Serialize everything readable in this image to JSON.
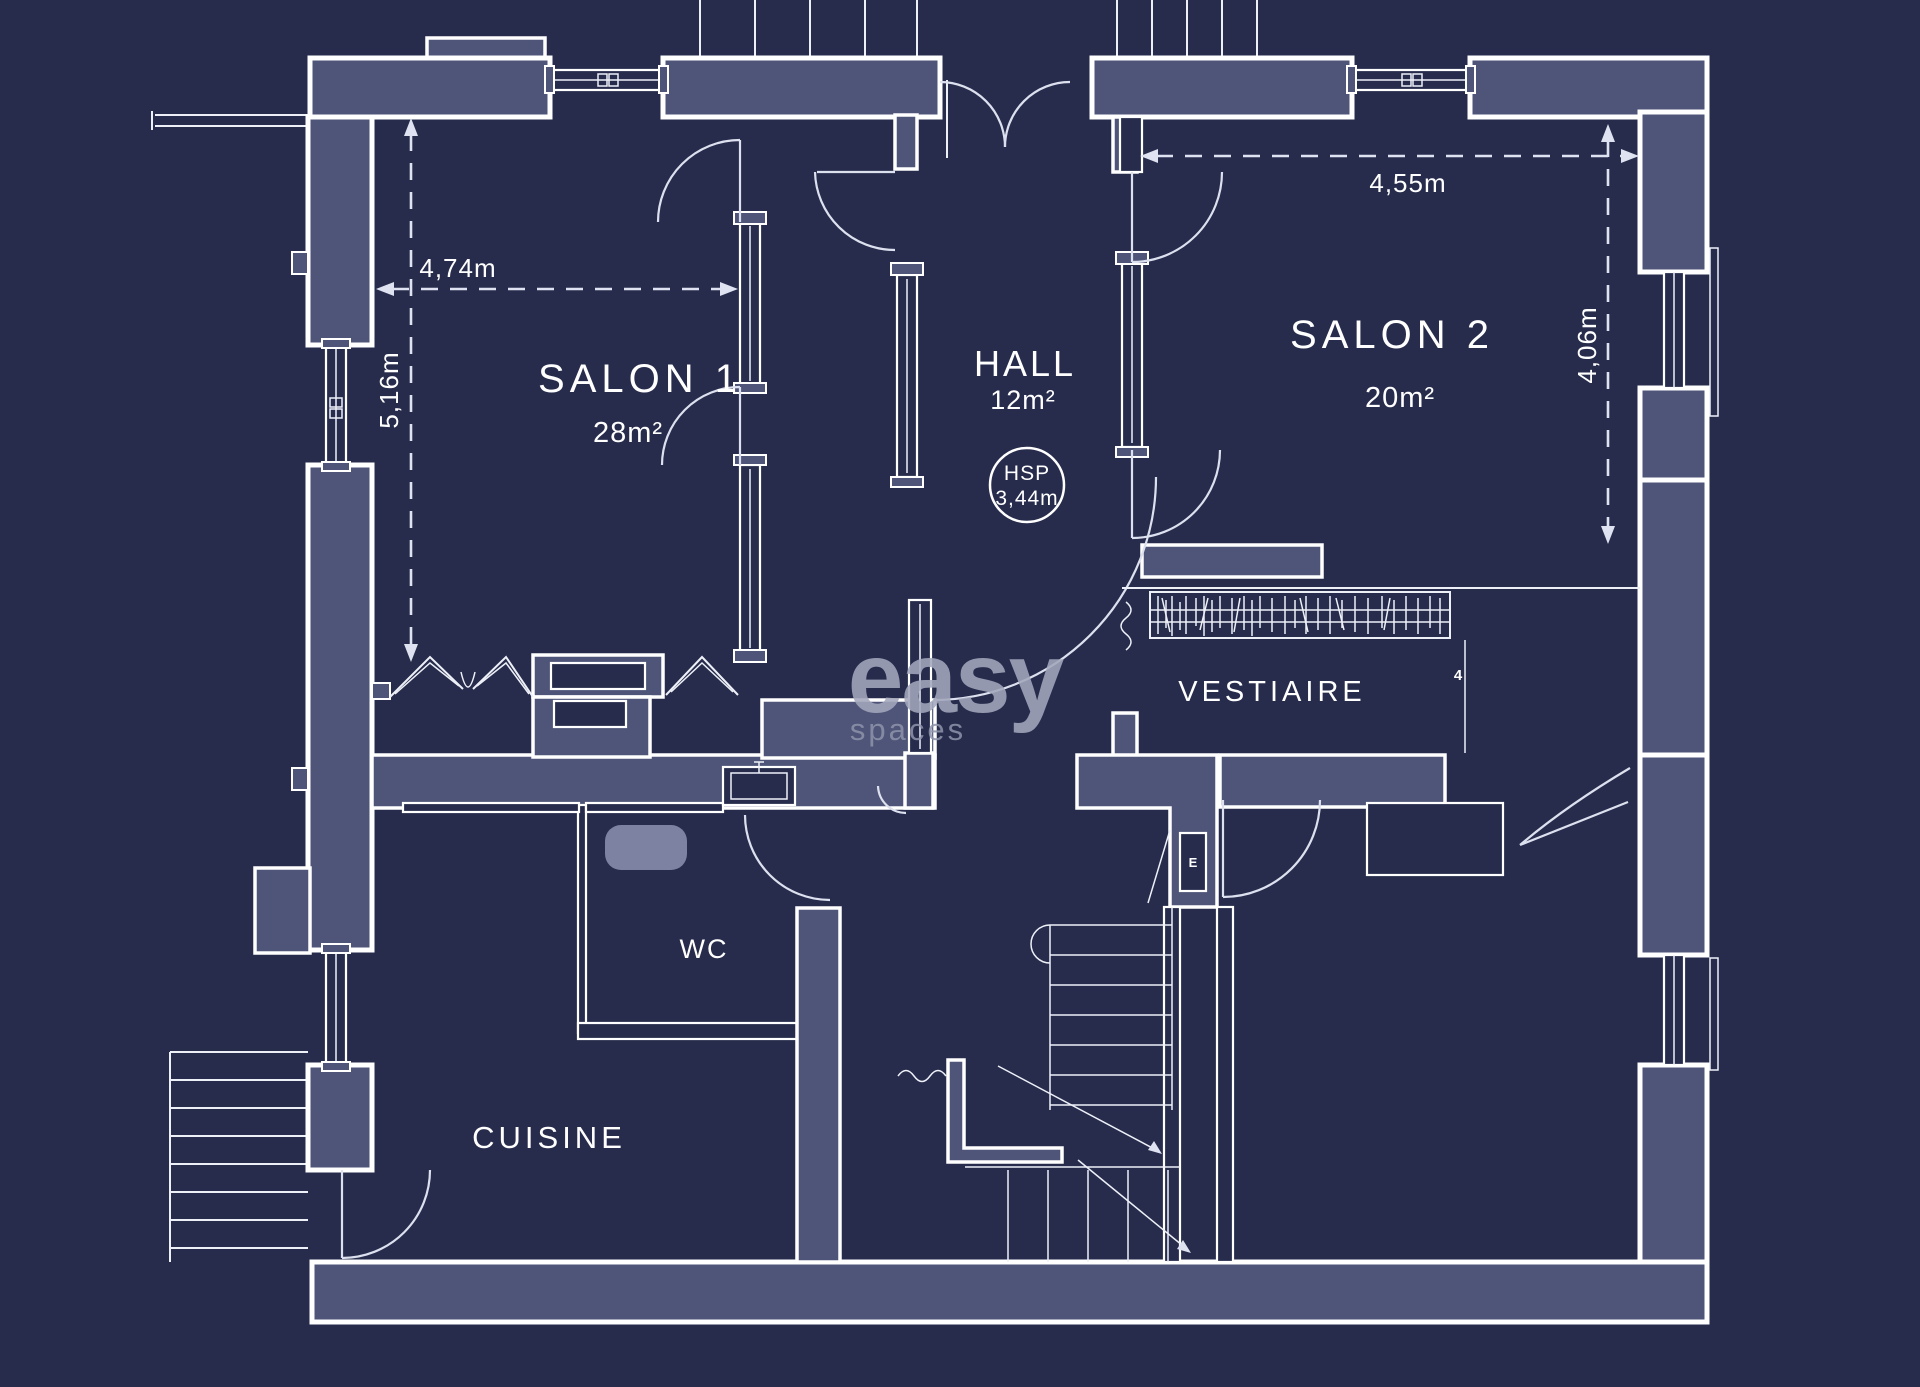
{
  "plan": {
    "type": "floor-plan-blueprint",
    "rooms": [
      {
        "id": "salon-1",
        "name": "SALON 1",
        "area": "28m²"
      },
      {
        "id": "hall",
        "name": "HALL",
        "area": "12m²"
      },
      {
        "id": "salon-2",
        "name": "SALON 2",
        "area": "20m²"
      },
      {
        "id": "vestiaire",
        "name": "VESTIAIRE",
        "area": ""
      },
      {
        "id": "wc",
        "name": "WC",
        "area": ""
      },
      {
        "id": "cuisine",
        "name": "CUISINE",
        "area": ""
      }
    ],
    "dimensions": [
      {
        "id": "salon1-width",
        "value": "4,74m",
        "orientation": "horizontal"
      },
      {
        "id": "salon1-depth",
        "value": "5,16m",
        "orientation": "vertical"
      },
      {
        "id": "salon2-width",
        "value": "4,55m",
        "orientation": "horizontal"
      },
      {
        "id": "salon2-depth",
        "value": "4,06m",
        "orientation": "vertical"
      }
    ],
    "ceiling_height": {
      "label": "HSP",
      "value": "3,44m"
    },
    "marks": {
      "electrical_panel": "E",
      "closet_dimension": "4"
    },
    "watermark": {
      "brand": "easy",
      "sub": "spaces"
    },
    "colors": {
      "background": "#272c4c",
      "wall_fill": "#4f5579",
      "line": "#ffffff",
      "dimension": "#dfe3f1",
      "watermark": "#a3a8bc",
      "fixture": "#7d82a2"
    }
  }
}
